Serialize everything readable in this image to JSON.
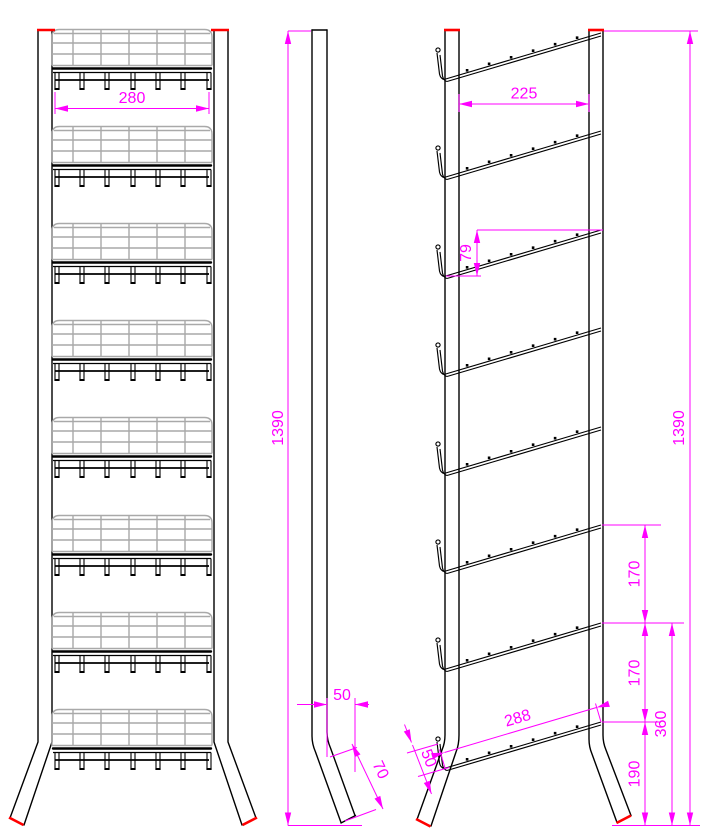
{
  "drawing": {
    "type": "Orthographic CAD views of an 8-pocket wire display rack with dimensions in millimetres",
    "shelf_count": 8,
    "colors": {
      "outline": "#000000",
      "wire_grid": "#a9a9a9",
      "dimension": "#ff00ff",
      "end_cap": "#ff0000",
      "background": "#ffffff"
    },
    "views": {
      "front": {
        "dim_width": "280"
      },
      "side": {
        "dim_height": "1390",
        "dim_post_depth": "50",
        "dim_foot_length": "70"
      },
      "rear": {
        "dim_inner_width": "225",
        "dim_shelf_drop": "79",
        "dim_shelf_gap_upper": "170",
        "dim_shelf_gap_lower": "170",
        "dim_shelf_to_ground": "360",
        "dim_bottom_shelf_to_ground": "190",
        "dim_shelf_length": "288",
        "dim_lip_height": "50",
        "dim_total_height": "1390"
      }
    }
  }
}
